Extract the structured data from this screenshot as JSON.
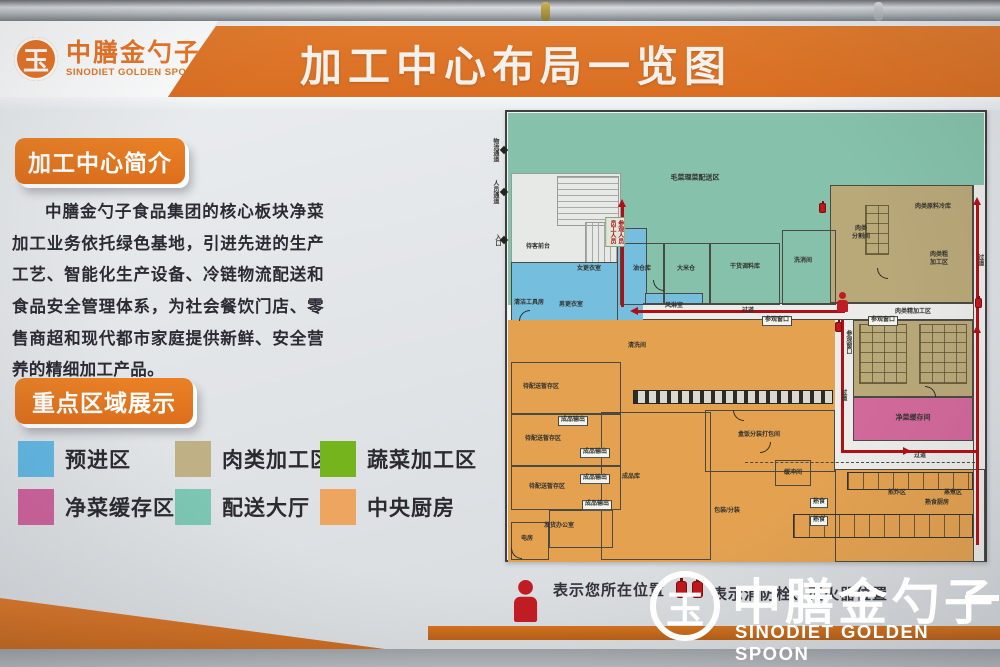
{
  "brand": {
    "name_cn": "中膳金勺子",
    "name_en": "SINODIET GOLDEN SPOON",
    "logo_glyph": "玉"
  },
  "header": {
    "title": "加工中心布局一览图"
  },
  "intro": {
    "heading": "加工中心简介",
    "body": "中膳金勺子食品集团的核心板块净菜加工业务依托绿色基地，引进先进的生产工艺、智能化生产设备、冷链物流配送和食品安全管理体系，为社会餐饮门店、零售商超和现代都市家庭提供新鲜、安全营养的精细加工产品。"
  },
  "legend": {
    "heading": "重点区域展示",
    "items": [
      {
        "label": "预进区",
        "color": "#62b8e3"
      },
      {
        "label": "肉类加工区",
        "color": "#c0b086"
      },
      {
        "label": "蔬菜加工区",
        "color": "#76b41e"
      },
      {
        "label": "净菜缓存区",
        "color": "#cf639c"
      },
      {
        "label": "配送大厅",
        "color": "#7cc7b4"
      },
      {
        "label": "中央厨房",
        "color": "#eea55f"
      }
    ]
  },
  "colors": {
    "accent_orange": "#dd7128",
    "path_red": "#ae1015",
    "plan_teal": "#86c2ab",
    "plan_blue": "#76bedd",
    "plan_orange": "#e4a251",
    "plan_tan": "#b9a878",
    "plan_pink": "#d2699b",
    "plan_corridor": "#ecedea",
    "plan_grey": "#e7e9e6"
  },
  "floorplan": {
    "hall": "毛菜理菜配送区",
    "reception": "待客前台",
    "logistics_corridor": "物流通道",
    "staff_corridor": "人员通道",
    "entrance": "入口",
    "visitor_entry": "参观人员\n员工人员",
    "women_changing": "女更衣室",
    "men_changing": "男更衣室",
    "cleaning_tools": "清洁工具房",
    "air_shower": "风淋室",
    "oil_store": "油仓库",
    "rice_store": "大米仓",
    "dry_seasoning_store": "干货调料库",
    "wash_sanitize": "洗消间",
    "aisle": "过道",
    "viewing_window": "参观窗口",
    "meat_cold_store": "肉类原料冷库",
    "meat_cutting": "肉类\n分割间",
    "meat_rough": "肉类粗\n加工区",
    "meat_fine": "肉类精加工区",
    "veg_buffer": "净菜缓存间",
    "washing_room": "清洗间",
    "dispatch_buffer": "待配送暂存区",
    "product_output": "成品输出",
    "product_store": "成品库",
    "shipping_office": "发货办公室",
    "power_room": "电房",
    "boxmeal_packing": "盒饭分装打包间",
    "packing": "包装/分装",
    "buffer_room": "缓冲间",
    "cooked_kitchen": "熟食厨房",
    "frying_zone": "煎炸区",
    "steaming_zone": "蒸煮区",
    "cooked_pass": "熟食"
  },
  "footer": {
    "marker_person": "表示您所在位置",
    "marker_fire": "表示消防栓、灭火器位置"
  }
}
